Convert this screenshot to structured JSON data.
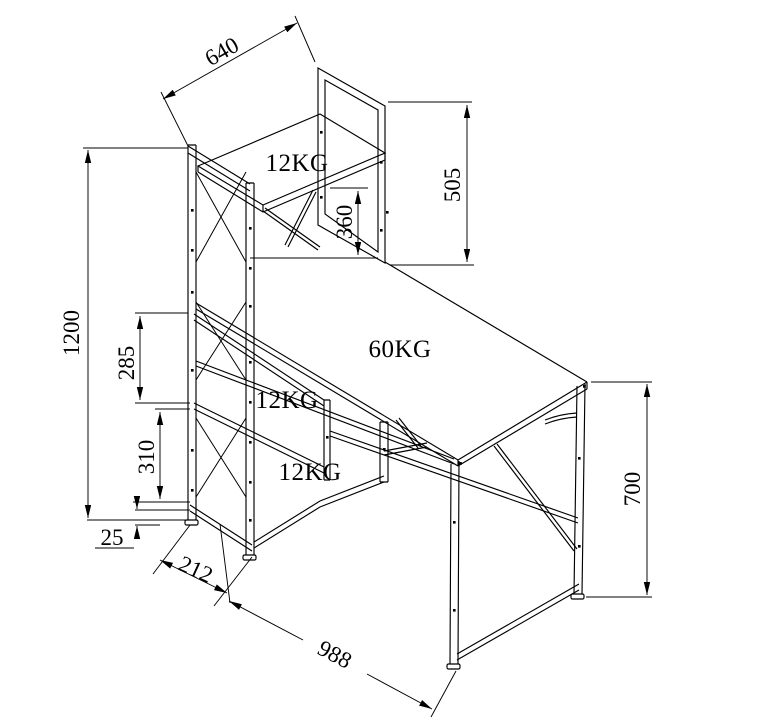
{
  "drawing": {
    "kind": "isometric dimension drawing",
    "subject": "computer desk with 4-tier bookshelf tower",
    "line_color": "#000000",
    "background_color": "#ffffff",
    "load_labels": {
      "top_shelf": "12KG",
      "desktop": "60KG",
      "middle_shelf": "12KG",
      "bottom_shelf": "12KG"
    },
    "dimensions": {
      "shelf_length": "640",
      "hutch_height": "505",
      "desktop_to_top_shelf": "360",
      "tower_height": "1200",
      "upper_shelf_spacing": "285",
      "lower_shelf_spacing": "310",
      "base_clearance": "25",
      "tower_width": "212",
      "desk_width": "988",
      "desk_height": "700"
    }
  }
}
